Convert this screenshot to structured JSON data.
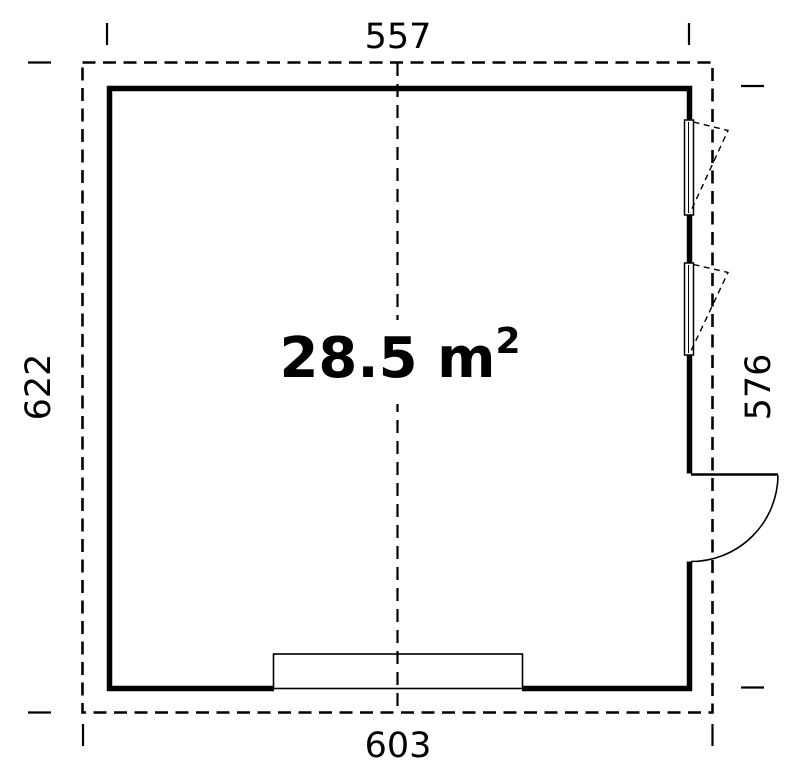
{
  "page": {
    "background_color": "#ffffff",
    "line_color": "#000000"
  },
  "floor_plan": {
    "type": "garage-floor-plan",
    "area_label": {
      "main": "28.5 m",
      "superscript": "2"
    },
    "dimensions": {
      "top": "557",
      "bottom": "603",
      "left": "622",
      "right": "576"
    },
    "symbols": {
      "window_count": 2,
      "door_count": 1,
      "garage_opening_count": 1,
      "outline_styles": {
        "roof_overhang": "dashed",
        "walls": "solid-thick",
        "center_axis": "dashed"
      }
    }
  }
}
